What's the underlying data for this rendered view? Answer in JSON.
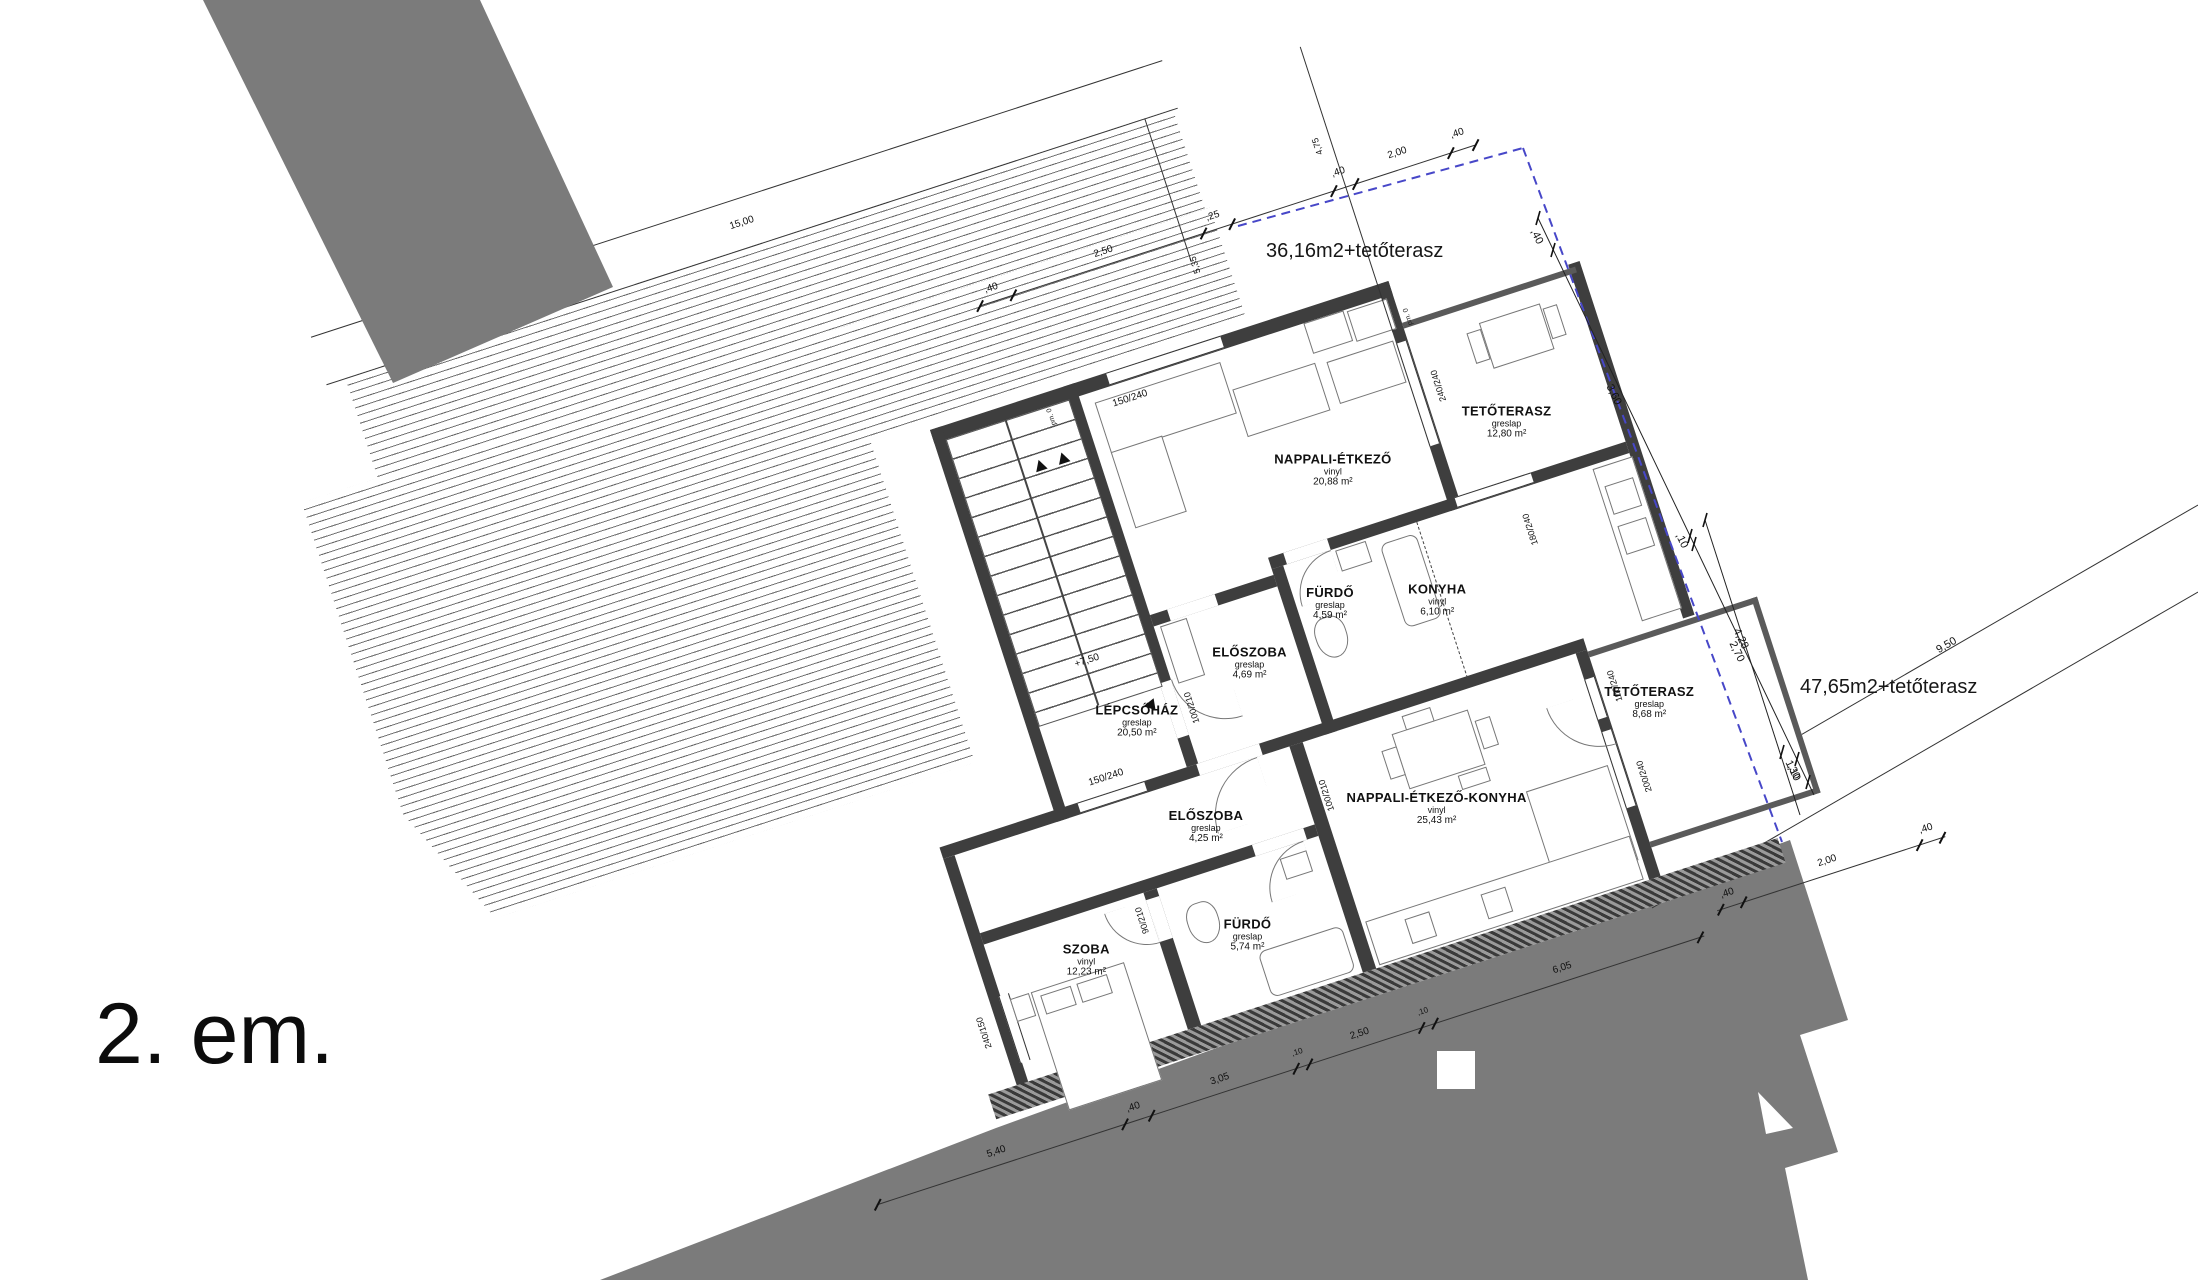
{
  "floor_label": "2. em.",
  "annotations": {
    "area_top": "36,16m2+tetőterasz",
    "area_right": "47,65m2+tetőterasz",
    "level": "+7,50"
  },
  "rooms": [
    {
      "name": "NAPPALI-ÉTKEZŐ",
      "finish": "vinyl",
      "area": "20,88 m²"
    },
    {
      "name": "TETŐTERASZ",
      "finish": "greslap",
      "area": "12,80 m²"
    },
    {
      "name": "KONYHA",
      "finish": "vinyl",
      "area": "6,10 m²"
    },
    {
      "name": "FÜRDŐ",
      "finish": "greslap",
      "area": "4,59 m²"
    },
    {
      "name": "ELŐSZOBA",
      "finish": "greslap",
      "area": "4,69 m²"
    },
    {
      "name": "LÉPCSŐHÁZ",
      "finish": "greslap",
      "area": "20,50 m²"
    },
    {
      "name": "ELŐSZOBA",
      "finish": "greslap",
      "area": "4,25 m²"
    },
    {
      "name": "FÜRDŐ",
      "finish": "greslap",
      "area": "5,74 m²"
    },
    {
      "name": "SZOBA",
      "finish": "vinyl",
      "area": "12,23 m²"
    },
    {
      "name": "NAPPALI-ÉTKEZŐ-KONYHA",
      "finish": "vinyl",
      "area": "25,43 m²"
    },
    {
      "name": "TETŐTERASZ",
      "finish": "greslap",
      "area": "8,68 m²"
    }
  ],
  "dimensions": {
    "d1500": "15,00",
    "d475": "4,75",
    "d535": "5,35",
    "d950": "9,50",
    "d428": "4,28",
    "d110": "1,10",
    "top_chain": [
      ",40",
      "2,50",
      ",25"
    ],
    "top_chain2": [
      ",40",
      "2,00",
      ",40"
    ],
    "right_chain": [
      ",40",
      "3,60",
      ",10",
      "2,70",
      ",30"
    ],
    "bottom_chain": [
      "5,40",
      ",40",
      "3,05",
      ",10",
      "2,50",
      ",10",
      "6,05"
    ],
    "bottom_chain2": [
      ",40",
      "2,00",
      ",40"
    ],
    "openings": {
      "top_window": "150/240",
      "terrace_door": "240/240",
      "kitchen_window": "180/240",
      "stair_door": "100/210",
      "hall_window": "150/240",
      "bath_door": "100/210",
      "room_door": "90/210",
      "terrace2_window": "100/240",
      "terrace2_door": "200/240",
      "room_window": "240/150"
    },
    "parapet": "pm. 0"
  },
  "colors": {
    "wall": "#3e3e3e",
    "mass_gray": "#7b7b7b",
    "boundary_blue": "#4747c8"
  }
}
